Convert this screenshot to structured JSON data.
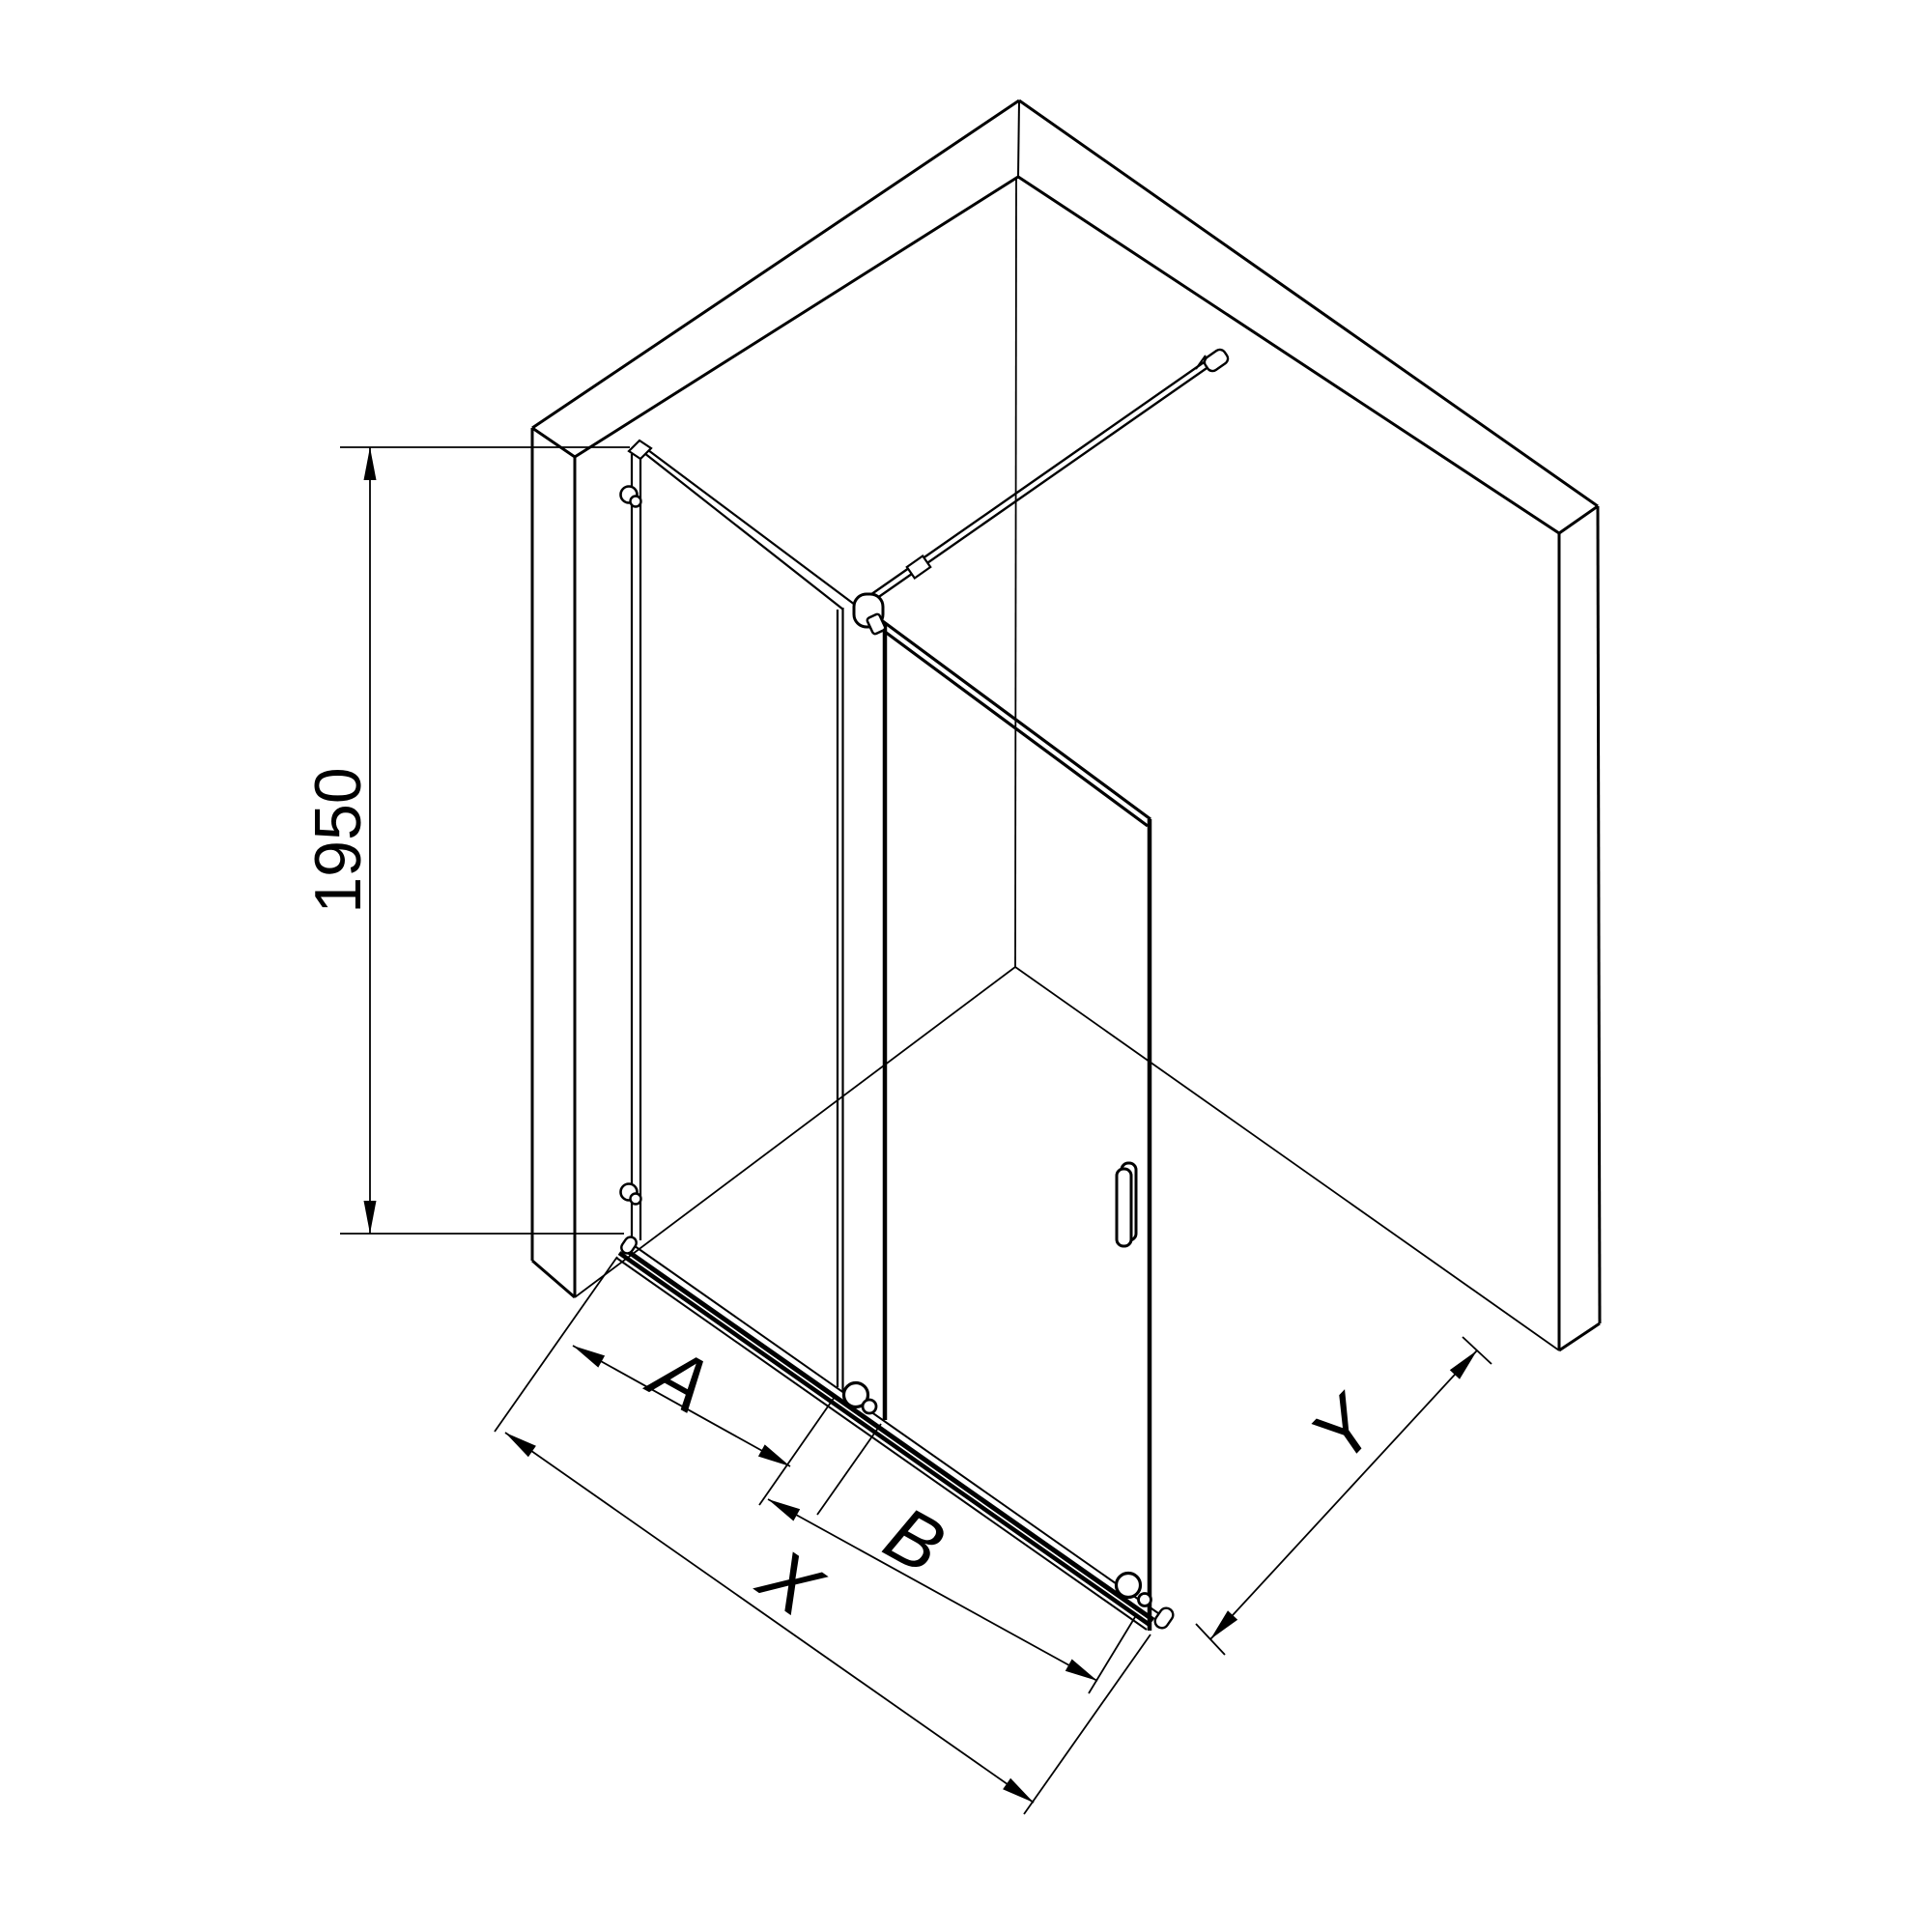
{
  "canvas": {
    "background_color": "#ffffff",
    "line_color": "#000000"
  },
  "diagram": {
    "type": "isometric technical line drawing",
    "subject": "walk-in shower screen with sliding door, two walls, support bar and bottom roller rail",
    "labels": {
      "height": "1950",
      "fixed_panel_width": "A",
      "door_width": "B",
      "total_width": "X",
      "side_clearance": "Y"
    }
  }
}
